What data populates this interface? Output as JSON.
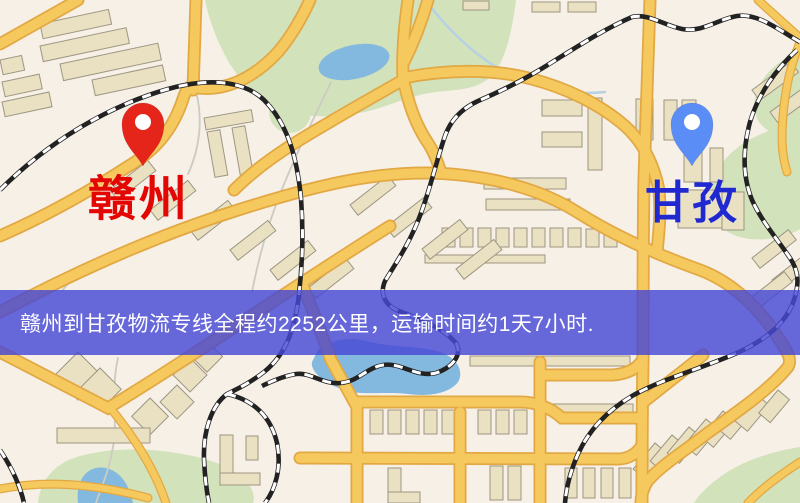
{
  "banner": {
    "text": "赣州到甘孜物流专线全程约2252公里，运输时间约1天7小时."
  },
  "markers": {
    "origin": {
      "label": "赣州"
    },
    "destination": {
      "label": "甘孜"
    }
  },
  "colors": {
    "banner_bg": "rgba(70,72,212,0.82)",
    "banner_text": "#ffffff",
    "origin_pin": "#e6251a",
    "origin_pin_hole": "#ffffff",
    "origin_label": "#e30603",
    "dest_pin": "#5a8df5",
    "dest_pin_hole": "#ffffff",
    "dest_label": "#2029cf",
    "map_land": "#f6f0e7",
    "map_park": "#d2e2bb",
    "map_water": "#84b9df",
    "map_road": "#f6c95e",
    "map_road_casing": "#e2a843",
    "map_building": "#eae0c2",
    "map_building_stroke": "#9d9682",
    "map_rail": "#222222",
    "map_rail_dash": "#ffffff"
  }
}
